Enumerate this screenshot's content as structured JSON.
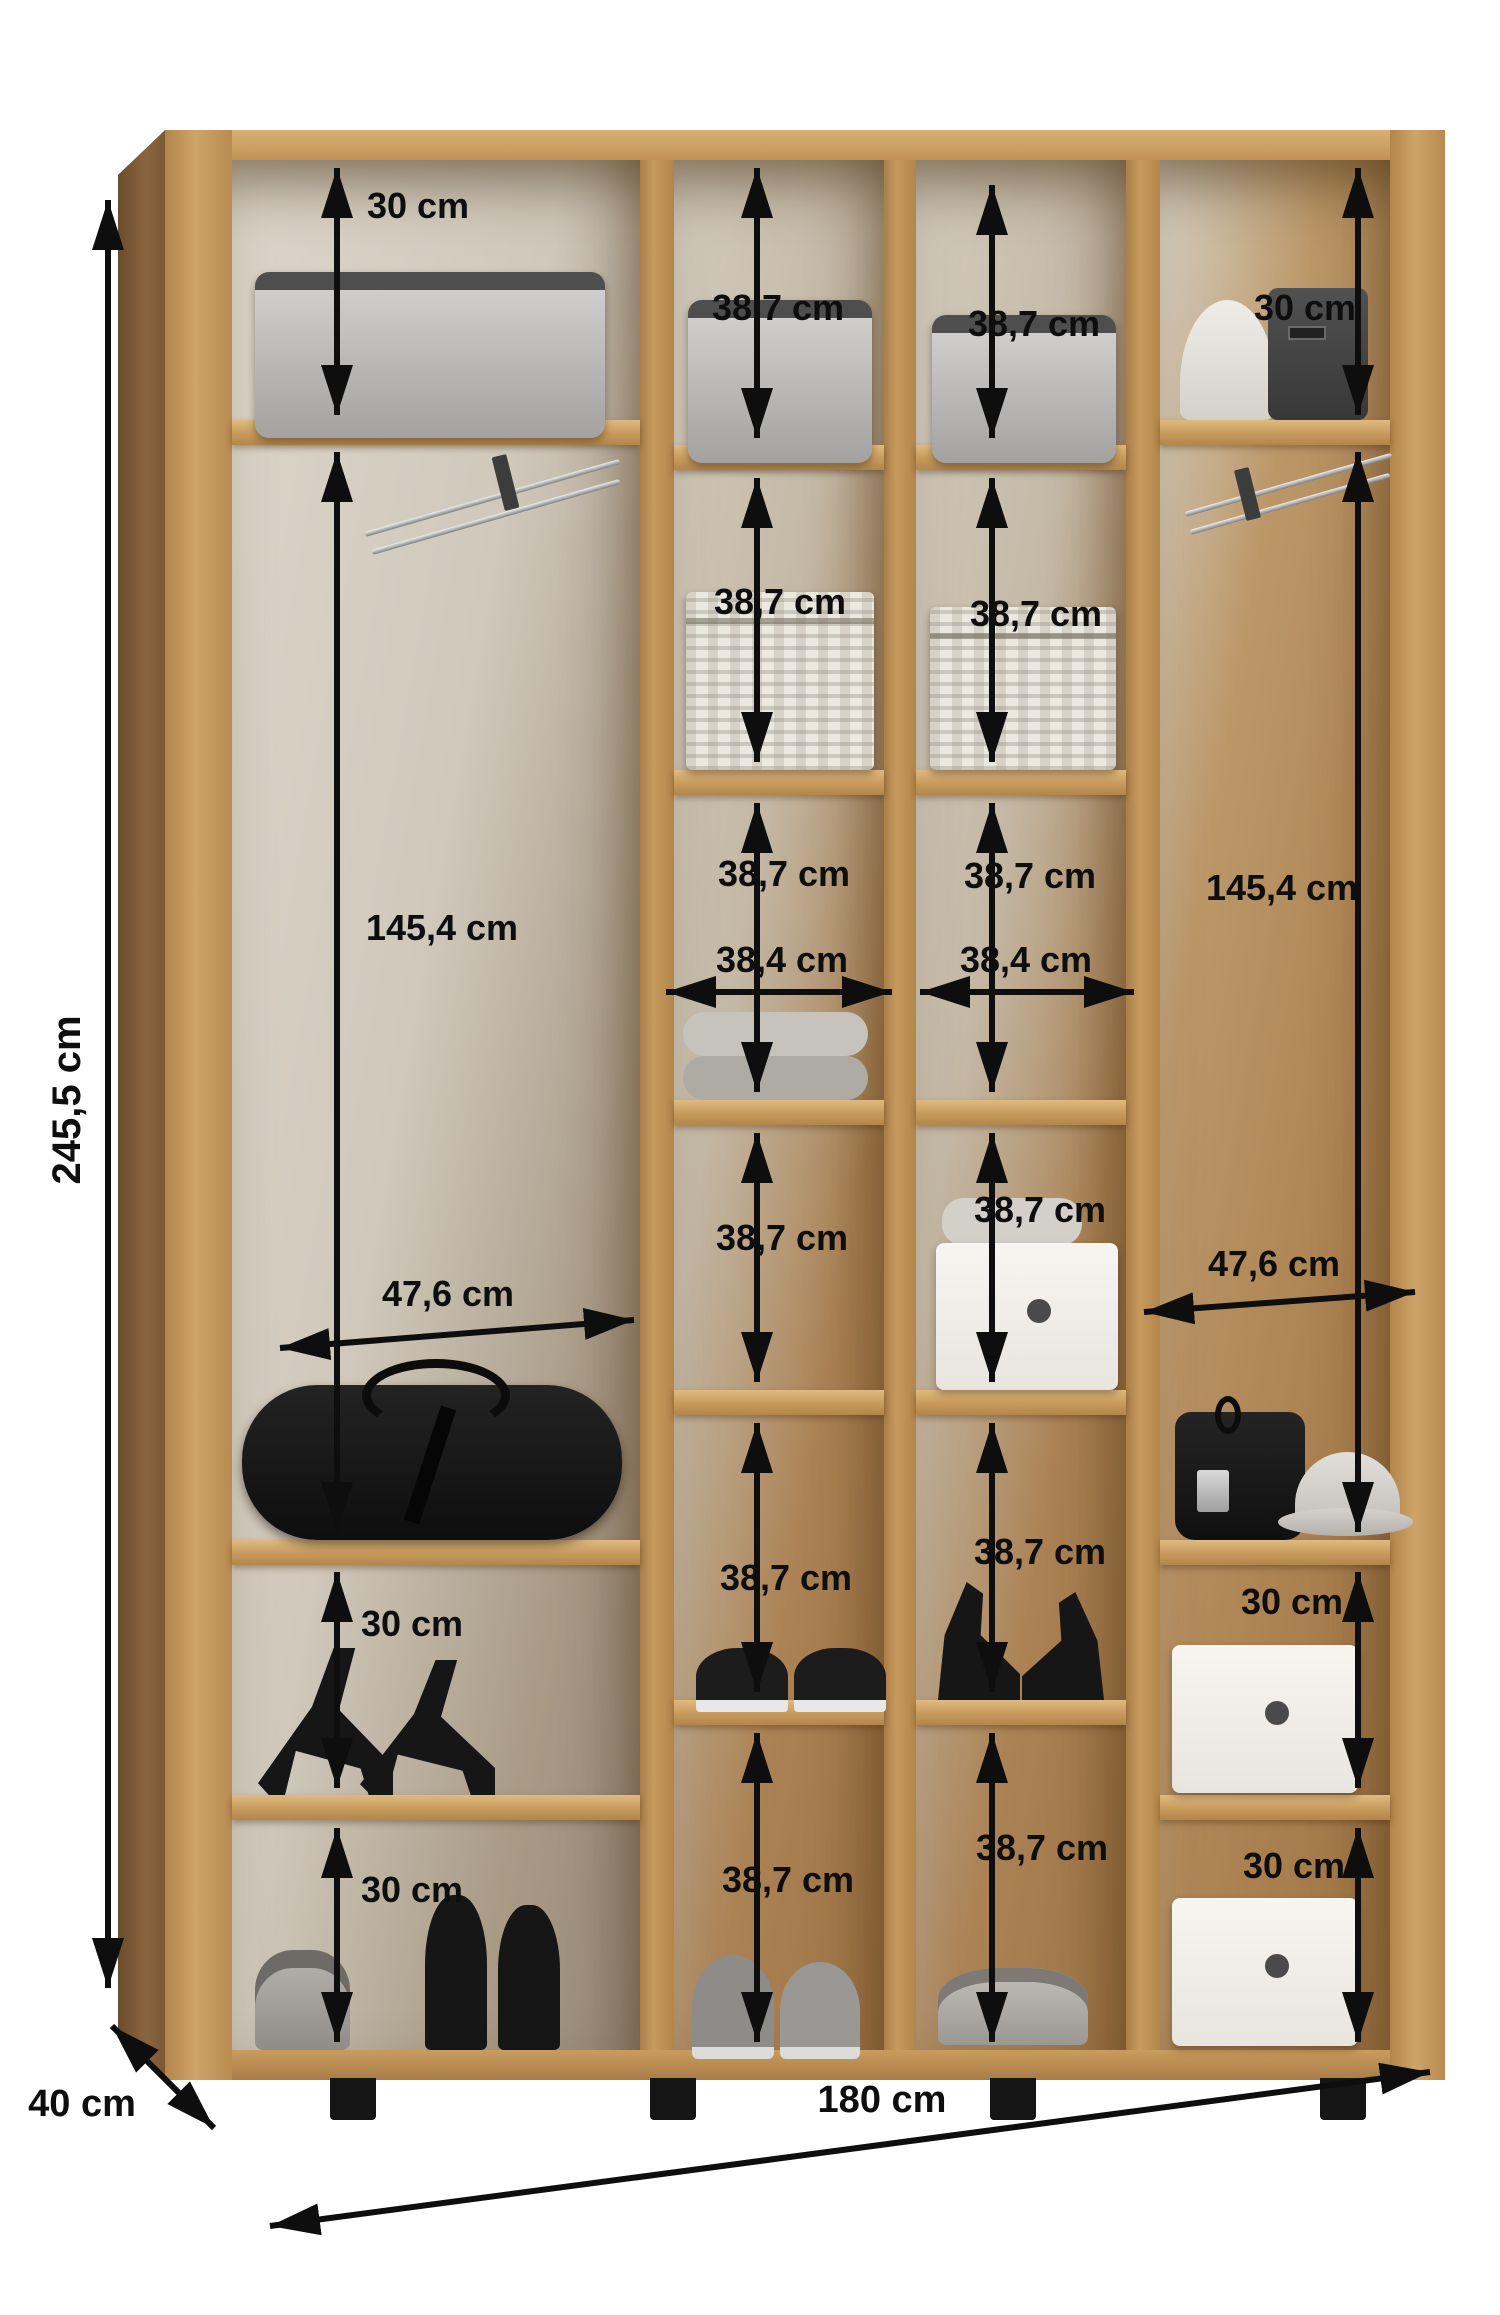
{
  "diagram": {
    "type": "wardrobe-interior-dimension-diagram",
    "overall": {
      "height": "245,5 cm",
      "width": "180 cm",
      "depth": "40 cm"
    },
    "column1": {
      "top_compartment": "30 cm",
      "hanging_space": "145,4 cm",
      "inner_width": "47,6 cm",
      "shoe_compartment_upper": "30 cm",
      "shoe_compartment_lower": "30 cm"
    },
    "column2": {
      "inner_width": "38,4 cm",
      "compartments": [
        "38,7 cm",
        "38,7 cm",
        "38,7 cm",
        "38,7 cm",
        "38,7 cm",
        "38,7 cm"
      ]
    },
    "column3": {
      "inner_width": "38,4 cm",
      "compartments": [
        "38,7 cm",
        "38,7 cm",
        "38,7 cm",
        "38,7 cm",
        "38,7 cm",
        "38,7 cm"
      ]
    },
    "column4": {
      "top_compartment": "30 cm",
      "hanging_space": "145,4 cm",
      "inner_width": "47,6 cm",
      "bin_compartment_upper": "30 cm",
      "bin_compartment_lower": "30 cm"
    },
    "items": {
      "column1": [
        "grey soft storage box",
        "pull-out clothes rail",
        "black duffel bag",
        "black high-heel sandals",
        "grey sandals",
        "black ankle shoes"
      ],
      "column2": [
        "grey soft storage box",
        "wicker basket with lid",
        "folded towels",
        "black flat shoes",
        "grey sneakers"
      ],
      "column3": [
        "grey soft storage box",
        "wicker basket with lid",
        "white bin with towel",
        "black wedge sandals",
        "grey sandals"
      ],
      "column4": [
        "white hat",
        "dark garment bag",
        "pull-out clothes rail",
        "black handbag",
        "grey hat",
        "white storage bin",
        "white storage bin"
      ]
    },
    "colors": {
      "wood": "#c49659",
      "wood_dark": "#8a6540",
      "dimension_lines": "#0e0e0e",
      "background": "#ffffff"
    }
  }
}
